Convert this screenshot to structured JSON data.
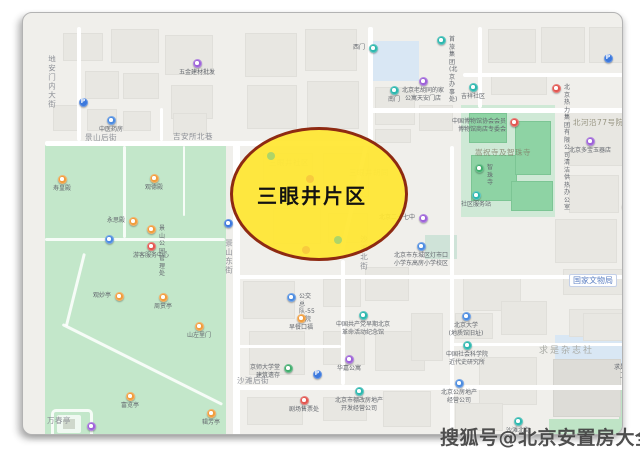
{
  "annotation": {
    "title": "三眼井片区"
  },
  "watermark": {
    "text": "搜狐号@北京安置房大全"
  },
  "colors": {
    "ellipse_fill": "#ffe631",
    "ellipse_border": "#8e2a12",
    "park_green": "#c3e7ca",
    "road_white": "#ffffff",
    "building_gray": "#e8e7e2",
    "poi_teal": "#2cb7ae",
    "poi_blue": "#4b8be0",
    "poi_parking_blue": "#3b78dd",
    "poi_purple": "#9d62d8",
    "poi_orange": "#f09d3d",
    "poi_red": "#e25650",
    "poi_green": "#41ad6d"
  },
  "map": {
    "street_labels": [
      {
        "text": "景山后街",
        "x": 62,
        "y": 121,
        "v": false
      },
      {
        "text": "吉安所北巷",
        "x": 150,
        "y": 120,
        "v": false
      },
      {
        "text": "地安门内大街",
        "x": 25,
        "y": 42,
        "v": true
      },
      {
        "text": "景山东街",
        "x": 202,
        "y": 226,
        "v": true
      },
      {
        "text": "沙滩北街",
        "x": 337,
        "y": 222,
        "v": true
      },
      {
        "text": "沙滩后街",
        "x": 214,
        "y": 364,
        "v": false
      },
      {
        "text": "北河沿大街",
        "x": 606,
        "y": 110,
        "v": true
      },
      {
        "text": "北河沿77号院",
        "x": 550,
        "y": 106,
        "v": false,
        "faint": true
      },
      {
        "text": "嵩祝寺及智珠寺",
        "x": 452,
        "y": 136,
        "v": false,
        "faint": true
      },
      {
        "text": "求是杂志社",
        "x": 516,
        "y": 334,
        "v": false,
        "big": true
      },
      {
        "text": "万春亭",
        "x": 24,
        "y": 404,
        "v": false
      },
      {
        "text": "三眼井社区",
        "x": 246,
        "y": 146,
        "v": false,
        "ghost": true
      },
      {
        "text": "三眼井胡同",
        "x": 326,
        "y": 156,
        "v": false,
        "ghost": true
      }
    ],
    "boxed_labels": [
      {
        "text": "国家文物局",
        "x": 546,
        "y": 261
      }
    ],
    "pois": [
      {
        "label": "五金建材批发",
        "x": 174,
        "y": 50,
        "c": "purple",
        "lp": "b"
      },
      {
        "label": "",
        "x": 60,
        "y": 89,
        "c": "pblue",
        "g": "P"
      },
      {
        "label": "中医药房",
        "x": 88,
        "y": 107,
        "c": "blue",
        "lp": "b"
      },
      {
        "label": "西门",
        "x": 350,
        "y": 35,
        "c": "teal",
        "lp": "l"
      },
      {
        "label": "首旅集团\n(北京办事处)",
        "x": 418,
        "y": 27,
        "c": "teal",
        "lp": "r"
      },
      {
        "label": "南门",
        "x": 371,
        "y": 77,
        "c": "teal",
        "lp": "b"
      },
      {
        "label": "北京老胡同的家\n公寓天安门店",
        "x": 400,
        "y": 68,
        "c": "purple",
        "lp": "b"
      },
      {
        "label": "吉祥社区",
        "x": 450,
        "y": 74,
        "c": "teal",
        "lp": "b"
      },
      {
        "label": "北京热力集团有限\n公司清洁供热办公室",
        "x": 533,
        "y": 75,
        "c": "red",
        "lp": "r"
      },
      {
        "label": "",
        "x": 585,
        "y": 45,
        "c": "pblue",
        "g": "P"
      },
      {
        "label": "中国博物馆协会会员\n博物馆商店专委会",
        "x": 491,
        "y": 109,
        "c": "red",
        "lp": "l"
      },
      {
        "label": "智珠寺",
        "x": 456,
        "y": 155,
        "c": "green",
        "lp": "r"
      },
      {
        "label": "社区服务站",
        "x": 453,
        "y": 182,
        "c": "teal",
        "lp": "b"
      },
      {
        "label": "北京多宝玉器店",
        "x": 567,
        "y": 128,
        "c": "purple",
        "lp": "b"
      },
      {
        "label": "",
        "x": 604,
        "y": 162,
        "c": "pblue",
        "g": "P"
      },
      {
        "label": "郡王府",
        "x": 603,
        "y": 193,
        "c": "orange",
        "lp": "r"
      },
      {
        "label": "北京二十七中",
        "x": 400,
        "y": 205,
        "c": "purple",
        "lp": "l"
      },
      {
        "label": "",
        "x": 205,
        "y": 210,
        "c": "pblue",
        "g": ""
      },
      {
        "label": "北京市东城区灯市口\n小学东高房小学校区",
        "x": 398,
        "y": 233,
        "c": "blue",
        "lp": "b"
      },
      {
        "label": "",
        "x": 605,
        "y": 293,
        "c": "pblue",
        "g": "P"
      },
      {
        "label": "公交总队-55号院",
        "x": 268,
        "y": 284,
        "c": "blue",
        "lp": "r"
      },
      {
        "label": "早餐口福",
        "x": 278,
        "y": 305,
        "c": "orange",
        "lp": "b"
      },
      {
        "label": "中国共产党早期北京\n革命活动纪念馆",
        "x": 340,
        "y": 302,
        "c": "teal",
        "lp": "b"
      },
      {
        "label": "京师大学堂\n建筑遗存",
        "x": 265,
        "y": 355,
        "c": "green",
        "lp": "l"
      },
      {
        "label": "",
        "x": 294,
        "y": 361,
        "c": "pblue",
        "g": "P"
      },
      {
        "label": "华嘉公寓",
        "x": 326,
        "y": 346,
        "c": "purple",
        "lp": "b"
      },
      {
        "label": "剧场售票处",
        "x": 281,
        "y": 387,
        "c": "red",
        "lp": "b"
      },
      {
        "label": "北京市棚改房地产\n开发经营公司",
        "x": 336,
        "y": 378,
        "c": "teal",
        "lp": "b"
      },
      {
        "label": "北京大学\n(地质馆旧址)",
        "x": 443,
        "y": 303,
        "c": "blue",
        "lp": "b"
      },
      {
        "label": "中国社会科学院\n近代史研究所",
        "x": 444,
        "y": 332,
        "c": "teal",
        "lp": "b"
      },
      {
        "label": "北京公房地产\n经营公司",
        "x": 436,
        "y": 370,
        "c": "blue",
        "lp": "b"
      },
      {
        "label": "沙滩北街\n停车场",
        "x": 495,
        "y": 408,
        "c": "teal",
        "lp": "b"
      },
      {
        "label": "求是杂志社\n卫生所",
        "x": 606,
        "y": 345,
        "c": "red",
        "lp": "b"
      },
      {
        "label": "寿皇殿",
        "x": 39,
        "y": 166,
        "c": "orange",
        "lp": "b"
      },
      {
        "label": "观德殿",
        "x": 131,
        "y": 165,
        "c": "orange",
        "lp": "b"
      },
      {
        "label": "永思殿",
        "x": 110,
        "y": 208,
        "c": "orange",
        "lp": "l"
      },
      {
        "label": "景山公园-管理处",
        "x": 128,
        "y": 216,
        "c": "orange",
        "lp": "r"
      },
      {
        "label": "游客服务中心",
        "x": 128,
        "y": 233,
        "c": "red",
        "lp": "b"
      },
      {
        "label": "",
        "x": 86,
        "y": 226,
        "c": "blue",
        "g": ""
      },
      {
        "label": "观妙亭",
        "x": 96,
        "y": 283,
        "c": "orange",
        "lp": "l"
      },
      {
        "label": "周赏亭",
        "x": 140,
        "y": 284,
        "c": "orange",
        "lp": "b"
      },
      {
        "label": "山左里门",
        "x": 176,
        "y": 313,
        "c": "orange",
        "lp": "b"
      },
      {
        "label": "富览亭",
        "x": 107,
        "y": 383,
        "c": "orange",
        "lp": "b"
      },
      {
        "label": "辑芳亭",
        "x": 188,
        "y": 400,
        "c": "orange",
        "lp": "b"
      },
      {
        "label": "",
        "x": 68,
        "y": 413,
        "c": "purple",
        "g": ""
      }
    ],
    "ghost_pois": [
      {
        "x": 248,
        "y": 143,
        "c": "teal"
      },
      {
        "x": 287,
        "y": 166,
        "c": "orange"
      },
      {
        "x": 315,
        "y": 227,
        "c": "teal"
      },
      {
        "x": 283,
        "y": 237,
        "c": "orange"
      }
    ]
  }
}
